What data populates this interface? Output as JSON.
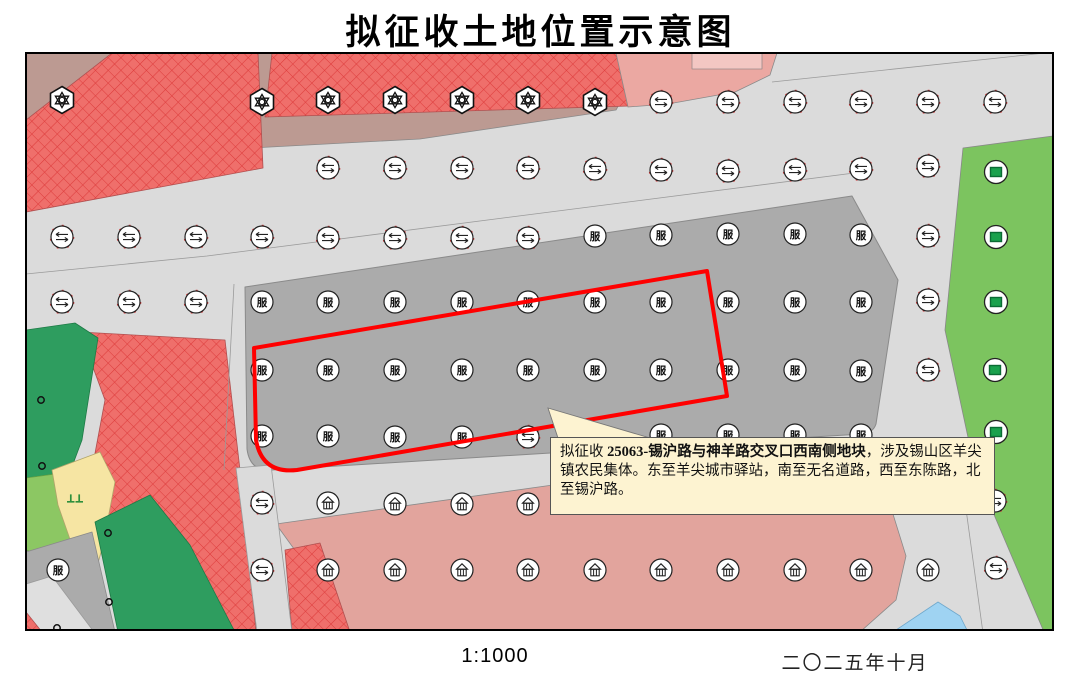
{
  "title": "拟征收土地位置示意图",
  "footer": {
    "scale": "1:1000",
    "date": "二〇二五年十月"
  },
  "callout": {
    "prefix": "拟征收 ",
    "bold": "25063-锡沪路与神羊路交叉口西南侧地块",
    "rest": "，涉及锡山区羊尖镇农民集体。东至羊尖城市驿站，南至无名道路，西至东陈路，北至锡沪路。"
  },
  "colors": {
    "road": "#DBDBDB",
    "parcel_gray": "#ABABAB",
    "mauve": "#BC9A92",
    "crosshatch_fill": "#EF6F6B",
    "crosshatch_line": "#DD3C3C",
    "pink": "#E2A49D",
    "pink_top": "#EBA8A2",
    "pink_top_light": "#F3C7C3",
    "green": "#7CC45F",
    "dark_green": "#2E9D5F",
    "light_green": "#8CC763",
    "yellow": "#F6E5A3",
    "blue": "#9FD3F2",
    "callout_bg": "#FDF3D1",
    "boundary_red": "#FF0000",
    "symbol_green": "#1AA14D"
  },
  "map": {
    "fu_glyph": "服",
    "symbol_types": {
      "gear": "industrial-plant-symbol",
      "road": "road-transport-symbol",
      "fu": "commercial-service-symbol",
      "house": "residential-warehouse-symbol",
      "green": "green-space-symbol",
      "dot": "survey-point-symbol",
      "grass": "grassland-symbol"
    },
    "symbols": [
      {
        "t": "gear",
        "x": 62,
        "y": 100
      },
      {
        "t": "gear",
        "x": 262,
        "y": 102
      },
      {
        "t": "gear",
        "x": 328,
        "y": 100
      },
      {
        "t": "gear",
        "x": 395,
        "y": 100
      },
      {
        "t": "gear",
        "x": 462,
        "y": 100
      },
      {
        "t": "gear",
        "x": 528,
        "y": 100
      },
      {
        "t": "gear",
        "x": 595,
        "y": 102
      },
      {
        "t": "road",
        "x": 661,
        "y": 102
      },
      {
        "t": "road",
        "x": 728,
        "y": 102
      },
      {
        "t": "road",
        "x": 795,
        "y": 102
      },
      {
        "t": "road",
        "x": 861,
        "y": 102
      },
      {
        "t": "road",
        "x": 928,
        "y": 102
      },
      {
        "t": "road",
        "x": 995,
        "y": 102
      },
      {
        "t": "road",
        "x": 328,
        "y": 168
      },
      {
        "t": "road",
        "x": 395,
        "y": 168
      },
      {
        "t": "road",
        "x": 462,
        "y": 168
      },
      {
        "t": "road",
        "x": 528,
        "y": 168
      },
      {
        "t": "road",
        "x": 595,
        "y": 169
      },
      {
        "t": "road",
        "x": 661,
        "y": 170
      },
      {
        "t": "road",
        "x": 728,
        "y": 171
      },
      {
        "t": "road",
        "x": 795,
        "y": 170
      },
      {
        "t": "road",
        "x": 861,
        "y": 169
      },
      {
        "t": "road",
        "x": 928,
        "y": 166
      },
      {
        "t": "road",
        "x": 62,
        "y": 237
      },
      {
        "t": "road",
        "x": 129,
        "y": 237
      },
      {
        "t": "road",
        "x": 196,
        "y": 237
      },
      {
        "t": "road",
        "x": 262,
        "y": 237
      },
      {
        "t": "road",
        "x": 328,
        "y": 238
      },
      {
        "t": "road",
        "x": 395,
        "y": 238
      },
      {
        "t": "road",
        "x": 462,
        "y": 238
      },
      {
        "t": "road",
        "x": 528,
        "y": 238
      },
      {
        "t": "road",
        "x": 928,
        "y": 236
      },
      {
        "t": "fu",
        "x": 595,
        "y": 236
      },
      {
        "t": "fu",
        "x": 661,
        "y": 235
      },
      {
        "t": "fu",
        "x": 728,
        "y": 234
      },
      {
        "t": "fu",
        "x": 795,
        "y": 234
      },
      {
        "t": "fu",
        "x": 861,
        "y": 235
      },
      {
        "t": "road",
        "x": 62,
        "y": 302
      },
      {
        "t": "road",
        "x": 129,
        "y": 302
      },
      {
        "t": "road",
        "x": 196,
        "y": 302
      },
      {
        "t": "fu",
        "x": 262,
        "y": 302
      },
      {
        "t": "fu",
        "x": 328,
        "y": 302
      },
      {
        "t": "fu",
        "x": 395,
        "y": 302
      },
      {
        "t": "fu",
        "x": 462,
        "y": 302
      },
      {
        "t": "fu",
        "x": 528,
        "y": 302
      },
      {
        "t": "fu",
        "x": 595,
        "y": 302
      },
      {
        "t": "fu",
        "x": 661,
        "y": 302
      },
      {
        "t": "fu",
        "x": 728,
        "y": 302
      },
      {
        "t": "fu",
        "x": 795,
        "y": 302
      },
      {
        "t": "fu",
        "x": 861,
        "y": 302
      },
      {
        "t": "road",
        "x": 928,
        "y": 300
      },
      {
        "t": "fu",
        "x": 262,
        "y": 370
      },
      {
        "t": "fu",
        "x": 328,
        "y": 370
      },
      {
        "t": "fu",
        "x": 395,
        "y": 370
      },
      {
        "t": "fu",
        "x": 462,
        "y": 370
      },
      {
        "t": "fu",
        "x": 528,
        "y": 370
      },
      {
        "t": "fu",
        "x": 595,
        "y": 370
      },
      {
        "t": "fu",
        "x": 661,
        "y": 370
      },
      {
        "t": "fu",
        "x": 728,
        "y": 370
      },
      {
        "t": "fu",
        "x": 795,
        "y": 370
      },
      {
        "t": "fu",
        "x": 861,
        "y": 371
      },
      {
        "t": "road",
        "x": 928,
        "y": 370
      },
      {
        "t": "fu",
        "x": 262,
        "y": 436
      },
      {
        "t": "fu",
        "x": 328,
        "y": 436
      },
      {
        "t": "fu",
        "x": 395,
        "y": 437
      },
      {
        "t": "fu",
        "x": 462,
        "y": 437
      },
      {
        "t": "road",
        "x": 528,
        "y": 437
      },
      {
        "t": "fu",
        "x": 595,
        "y": 435
      },
      {
        "t": "fu",
        "x": 661,
        "y": 435
      },
      {
        "t": "fu",
        "x": 728,
        "y": 435
      },
      {
        "t": "fu",
        "x": 795,
        "y": 435
      },
      {
        "t": "fu",
        "x": 861,
        "y": 435
      },
      {
        "t": "road",
        "x": 262,
        "y": 503
      },
      {
        "t": "house",
        "x": 328,
        "y": 503
      },
      {
        "t": "house",
        "x": 395,
        "y": 504
      },
      {
        "t": "house",
        "x": 462,
        "y": 504
      },
      {
        "t": "house",
        "x": 528,
        "y": 504
      },
      {
        "t": "road",
        "x": 995,
        "y": 501
      },
      {
        "t": "fu",
        "x": 58,
        "y": 570
      },
      {
        "t": "road",
        "x": 262,
        "y": 570
      },
      {
        "t": "house",
        "x": 328,
        "y": 570
      },
      {
        "t": "house",
        "x": 395,
        "y": 570
      },
      {
        "t": "house",
        "x": 462,
        "y": 570
      },
      {
        "t": "house",
        "x": 528,
        "y": 570
      },
      {
        "t": "house",
        "x": 595,
        "y": 570
      },
      {
        "t": "house",
        "x": 661,
        "y": 570
      },
      {
        "t": "house",
        "x": 728,
        "y": 570
      },
      {
        "t": "house",
        "x": 795,
        "y": 570
      },
      {
        "t": "house",
        "x": 861,
        "y": 570
      },
      {
        "t": "house",
        "x": 928,
        "y": 570
      },
      {
        "t": "road",
        "x": 996,
        "y": 568
      },
      {
        "t": "green",
        "x": 996,
        "y": 172
      },
      {
        "t": "green",
        "x": 996,
        "y": 237
      },
      {
        "t": "green",
        "x": 996,
        "y": 302
      },
      {
        "t": "green",
        "x": 995,
        "y": 370
      },
      {
        "t": "green",
        "x": 996,
        "y": 432
      },
      {
        "t": "dot",
        "x": 41,
        "y": 400
      },
      {
        "t": "dot",
        "x": 42,
        "y": 466
      },
      {
        "t": "dot",
        "x": 108,
        "y": 533
      },
      {
        "t": "dot",
        "x": 109,
        "y": 602
      },
      {
        "t": "dot",
        "x": 57,
        "y": 628
      },
      {
        "t": "grass",
        "x": 75,
        "y": 498
      }
    ]
  }
}
